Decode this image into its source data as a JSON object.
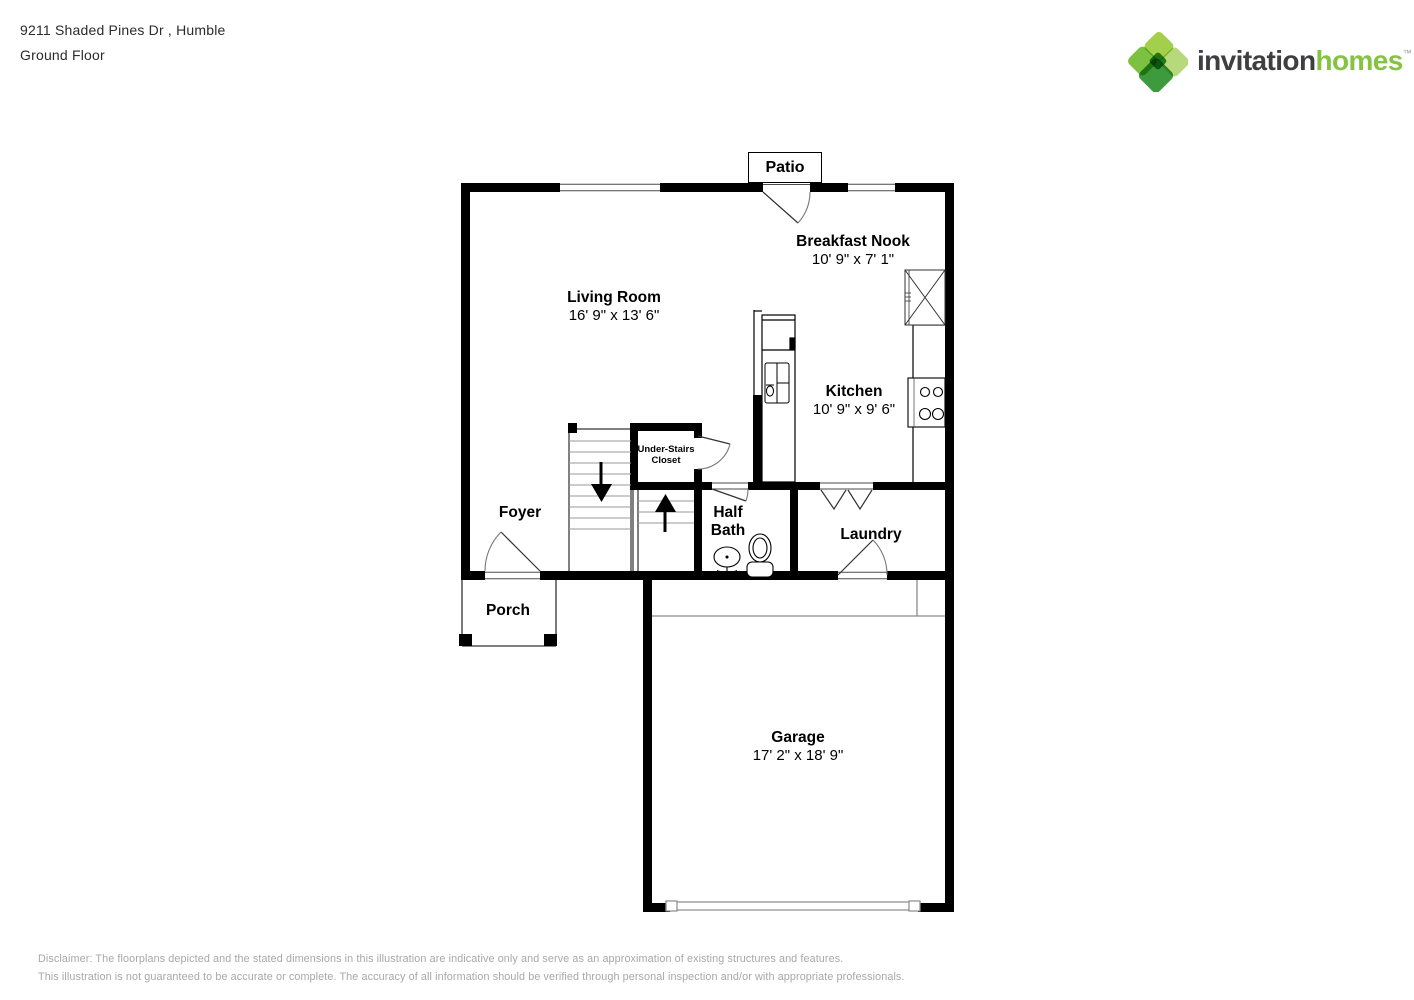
{
  "header": {
    "address": "9211 Shaded Pines Dr , Humble",
    "floor": "Ground Floor"
  },
  "logo": {
    "brand_dark": "invitation",
    "brand_green": "homes",
    "trademark": "™"
  },
  "plan": {
    "patio_label": "Patio",
    "rooms": {
      "living_room": {
        "name": "Living Room",
        "dims": "16' 9\" x 13' 6\""
      },
      "breakfast_nook": {
        "name": "Breakfast Nook",
        "dims": "10' 9\" x 7' 1\""
      },
      "kitchen": {
        "name": "Kitchen",
        "dims": "10' 9\" x 9' 6\""
      },
      "garage": {
        "name": "Garage",
        "dims": "17' 2\" x 18' 9\""
      },
      "foyer": {
        "name": "Foyer"
      },
      "half_bath": {
        "name": "Half Bath"
      },
      "laundry": {
        "name": "Laundry"
      },
      "porch": {
        "name": "Porch"
      },
      "under_stairs_closet": {
        "name": "Under-Stairs Closet"
      }
    }
  },
  "disclaimer": {
    "line1": "Disclaimer: The floorplans depicted and the stated dimensions in this illustration are indicative only and serve as an approximation of existing structures and features.",
    "line2": "This illustration is not guaranteed to be accurate or complete. The accuracy of all information should be verified through personal inspection and/or with appropriate professionals."
  },
  "colors": {
    "brand_green": "#85c342",
    "brand_dark": "#3f3f41",
    "wall": "#000000"
  }
}
